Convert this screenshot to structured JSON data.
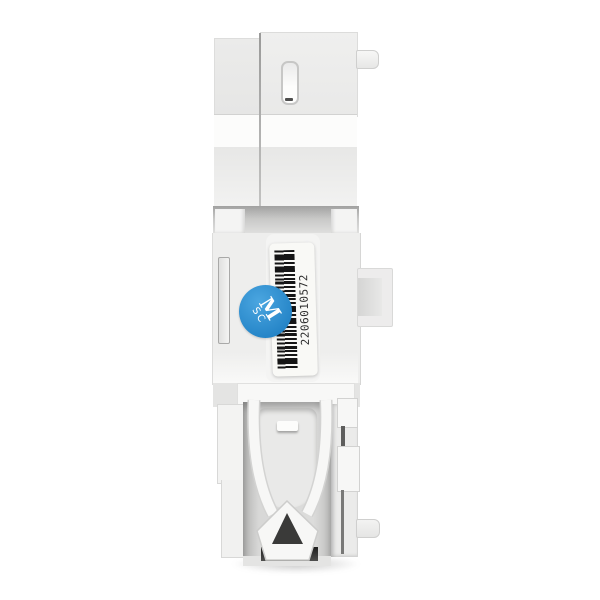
{
  "device": {
    "barcode_sticker": {
      "number": "2206010572"
    },
    "qc_sticker": {
      "line1": "M",
      "line2": "SC",
      "fill_color": "#2e94d5",
      "text_color": "#ffffff"
    },
    "colors": {
      "background": "#ffffff",
      "body": "#ececeb",
      "body_bright": "#fbfbfa",
      "recess_band": "#c2c2c1",
      "cavity": "#d6d6d5",
      "din_clip": "#f7f7f6",
      "slot_dark": "#2f2f2f",
      "barcode_label": "#f9f9f6"
    }
  }
}
